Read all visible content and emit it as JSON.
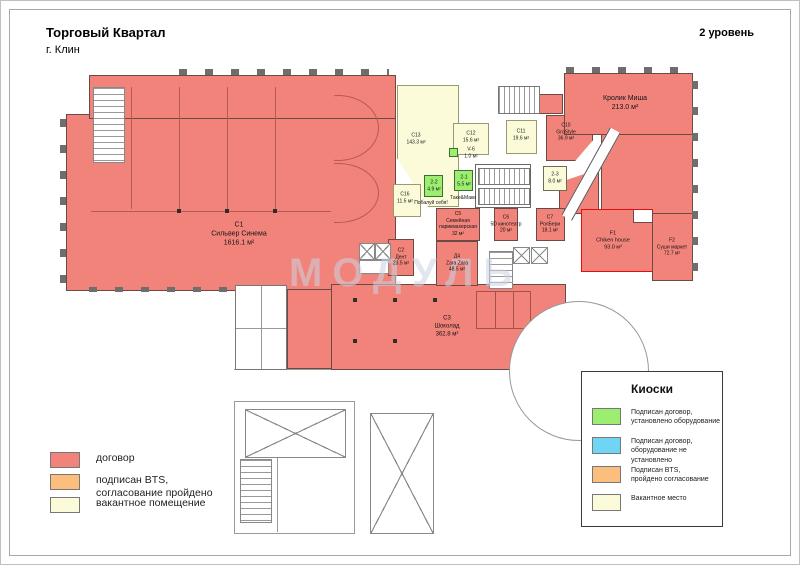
{
  "header": {
    "title": "Торговый Квартал",
    "subtitle": "г. Клин",
    "level": "2 уровень"
  },
  "watermark": "МОДУЛЬ",
  "colors": {
    "red": "#f2837b",
    "orange": "#fbbe7c",
    "cream": "#fbfbda",
    "green": "#9cee70",
    "blue": "#70d4f5"
  },
  "rooms": {
    "c1": {
      "code": "С1",
      "name": "Сильвер Синема",
      "area": "1616.1 м²"
    },
    "c13": {
      "code": "С13",
      "area": "143.3 м²"
    },
    "c12": {
      "code": "С12",
      "area": "15.6 м²"
    },
    "c16": {
      "code": "С16",
      "area": "11.5 м²"
    },
    "c11": {
      "code": "С11",
      "area": "19.6 м²"
    },
    "c10": {
      "code": "С10",
      "name": "GroStyle",
      "area": "36.9 м²"
    },
    "km": {
      "name": "Кролик Миша",
      "area": "213.0 м²"
    },
    "v6": {
      "code": "V-6",
      "area": "1.0 м²"
    },
    "k21": {
      "code": "2-1",
      "area": "5.5 м²",
      "caption": "Таке&Маки"
    },
    "k22": {
      "code": "2-2",
      "area": "4.9 м²",
      "caption": "Побалуй себя!"
    },
    "k23": {
      "code": "2-3",
      "area": "8.0 м²"
    },
    "c5": {
      "code": "С5",
      "name1": "Семейная",
      "name2": "парикмахерская",
      "area": "32 м²"
    },
    "c6": {
      "code": "С6",
      "name": "5D кинотеатр",
      "area": "20 м²"
    },
    "c7": {
      "code": "С7",
      "name": "РолБери",
      "area": "18.1 м²"
    },
    "d4": {
      "code": "Д4",
      "name": "Zara Zara",
      "area": "48.5 м²"
    },
    "c2": {
      "code": "С2",
      "name": "Дент",
      "area": "23.5 м²"
    },
    "f1": {
      "code": "F1",
      "name": "Chiken house",
      "area": "93.0 м²"
    },
    "f2": {
      "code": "F2",
      "name": "Суши маркет",
      "area": "72.7 м²"
    },
    "c3": {
      "code": "С3",
      "name": "Шоколад",
      "area": "362.8 м²"
    }
  },
  "legend": {
    "items": [
      {
        "color": "#f2837b",
        "label": "договор",
        "label2": ""
      },
      {
        "color": "#fbbe7c",
        "label": "подписан BTS,",
        "label2": "согласование пройдено"
      },
      {
        "color": "#fbfbda",
        "label": "вакантное помещение",
        "label2": ""
      }
    ]
  },
  "kiosk_legend": {
    "title": "Киоски",
    "items": [
      {
        "color": "#9cee70",
        "label": "Подписан договор,",
        "label2": "установлено оборудование"
      },
      {
        "color": "#70d4f5",
        "label": "Подписан договор,",
        "label2": "оборудование не установлено"
      },
      {
        "color": "#fbbe7c",
        "label": "Подписан BTS,",
        "label2": "пройдено согласование"
      },
      {
        "color": "#fbfbda",
        "label": "Вакантное место",
        "label2": ""
      }
    ]
  }
}
